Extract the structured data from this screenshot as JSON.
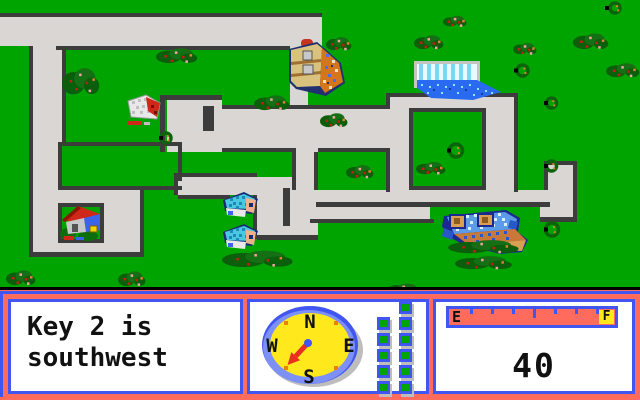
{
  "hud": {
    "message": {
      "line1": "Key 2 is",
      "line2": "southwest"
    },
    "compass": {
      "north": "N",
      "east": "E",
      "south": "S",
      "west": "W",
      "needle_direction": "southwest"
    },
    "gear": {
      "right_column_squares": 6,
      "left_column_squares": 5
    },
    "fuel": {
      "empty_label": "E",
      "full_label": "F",
      "tick_count": 7
    },
    "speed": {
      "value": "40"
    }
  },
  "map": {
    "objects": [
      "lumber-building",
      "pool-building",
      "small-house",
      "red-roof-house",
      "cyan-house-1",
      "cyan-house-2",
      "blue-bus"
    ]
  },
  "colors": {
    "hud_background": "#FF6B5C",
    "panel_border_blue": "#4156F0",
    "map_green": "#00A400",
    "road_grey": "#D9D6D3",
    "road_edge": "#3C3C3C",
    "compass_yellow": "#FFE81C",
    "needle_red": "#E83020",
    "gauge_fill": "#FF6B5C",
    "square_green": "#00A400",
    "marker_orange": "#F08000"
  }
}
